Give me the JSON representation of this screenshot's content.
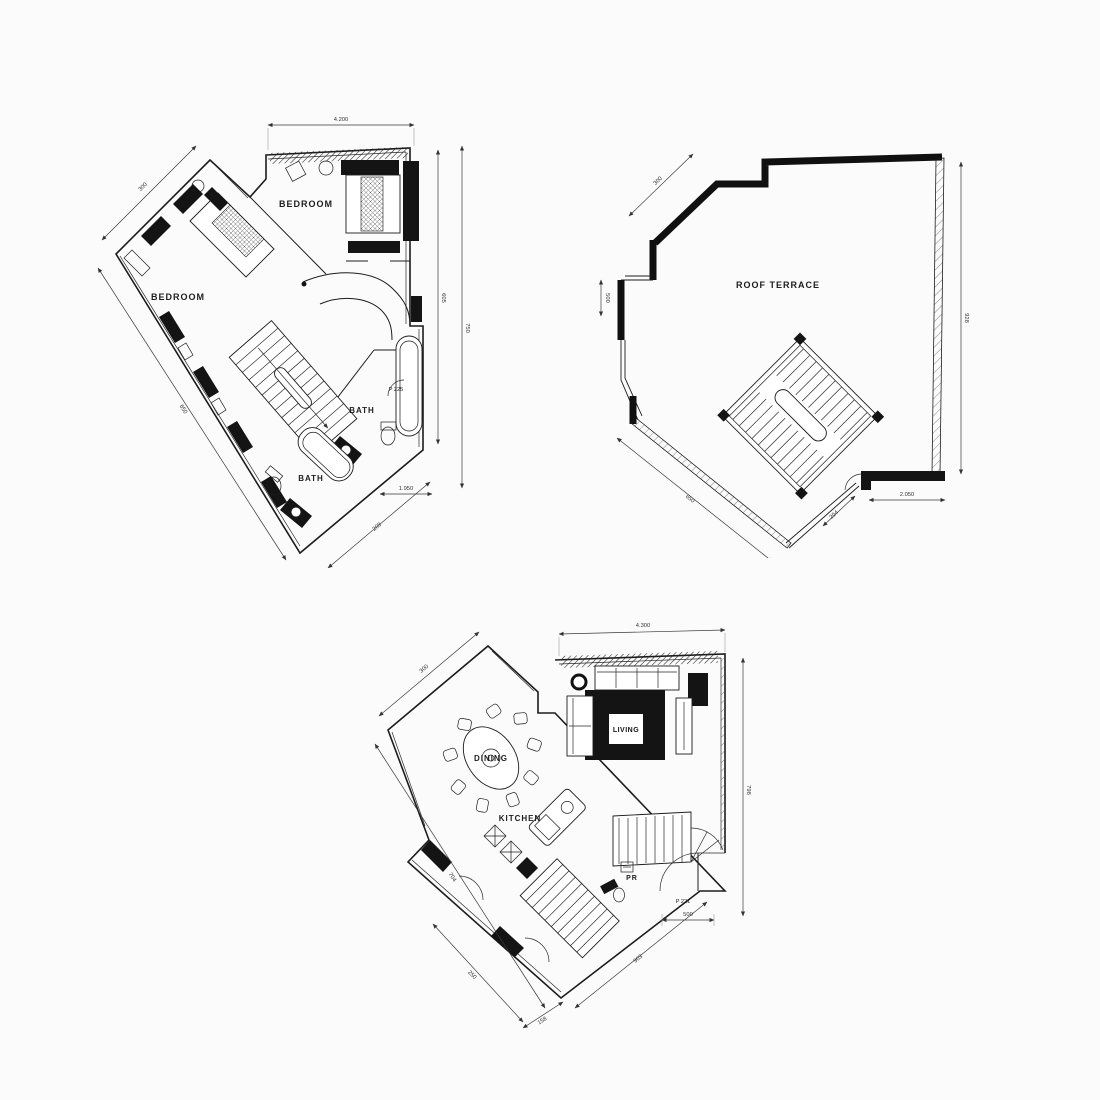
{
  "page": {
    "background": "#fbfbfb"
  },
  "plans": {
    "upper": {
      "labels": {
        "bedroom_left": "BEDROOM",
        "bedroom_right": "BEDROOM",
        "bath_upper": "BATH",
        "bath_lower": "BATH",
        "door_tag": "P 225"
      },
      "dims": {
        "top": "4.200",
        "right_inner": "605",
        "right_outer": "750",
        "left_upper": "300",
        "left_lower": "650",
        "bottom_diag": "209",
        "bath_width": "1.950"
      }
    },
    "roof": {
      "labels": {
        "terrace": "ROOF TERRACE"
      },
      "dims": {
        "right": "928",
        "left_upper": "300",
        "left_mid": "500",
        "bottom_left": "650",
        "bottom_right_h": "2.050",
        "bottom_right_d": "204"
      }
    },
    "lower": {
      "labels": {
        "living": "LIVING",
        "dining": "DINING",
        "kitchen": "KITCHEN",
        "pr": "PR",
        "door_tag": "P 221"
      },
      "dims": {
        "top": "4.300",
        "right": "798",
        "door": "500",
        "left_upper": "300",
        "left_lower": "704",
        "bottom_inner": "250",
        "bottom_small": "158",
        "bottom_right": "903"
      }
    }
  }
}
